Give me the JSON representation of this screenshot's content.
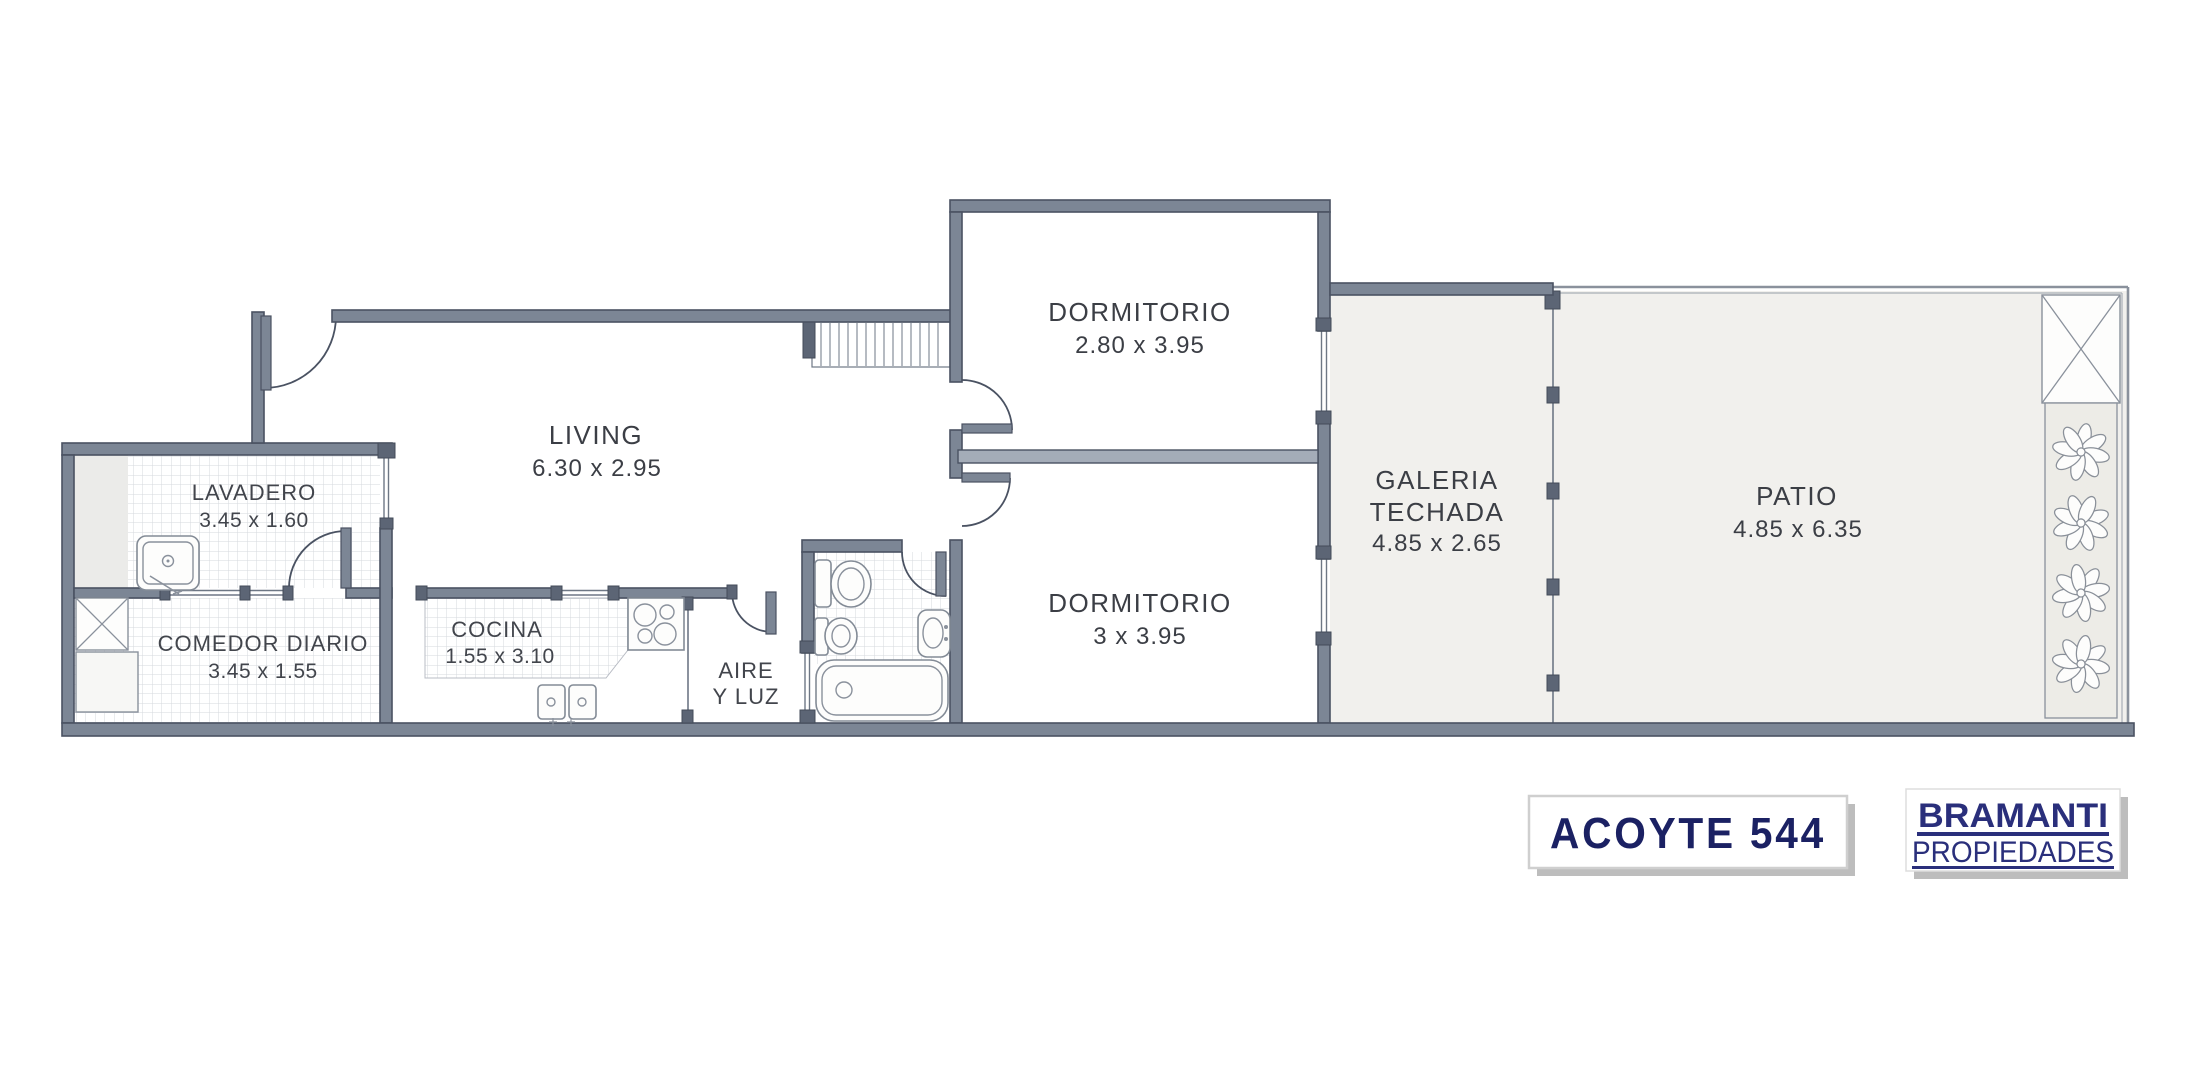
{
  "rooms": {
    "dormitorio1": {
      "name": "DORMITORIO",
      "dims": "2.80 x 3.95"
    },
    "dormitorio2": {
      "name": "DORMITORIO",
      "dims": "3 x 3.95"
    },
    "living": {
      "name": "LIVING",
      "dims": "6.30 x 2.95"
    },
    "lavadero": {
      "name": "LAVADERO",
      "dims": "3.45 x 1.60"
    },
    "comedor_diario": {
      "name": "COMEDOR DIARIO",
      "dims": "3.45 x 1.55"
    },
    "cocina": {
      "name": "COCINA",
      "dims": "1.55 x 3.10"
    },
    "aire_y_luz": {
      "line1": "AIRE",
      "line2": "Y LUZ"
    },
    "galeria": {
      "line1": "GALERIA",
      "line2": "TECHADA",
      "dims": "4.85 x 2.65"
    },
    "patio": {
      "name": "PATIO",
      "dims": "4.85 x 6.35"
    }
  },
  "address_plate": {
    "label": "ACOYTE 544"
  },
  "brand": {
    "name": "BRAMANTI",
    "tagline": "PROPIEDADES"
  },
  "colors": {
    "wall": "#7C8695",
    "wall_outline": "#4A5262",
    "outdoor_floor": "#F1F0ED",
    "tile_line": "#D5D8DE",
    "label_text": "#3B3E45",
    "plate_navy": "#1B2163",
    "brand_navy": "#2A2F7B"
  }
}
